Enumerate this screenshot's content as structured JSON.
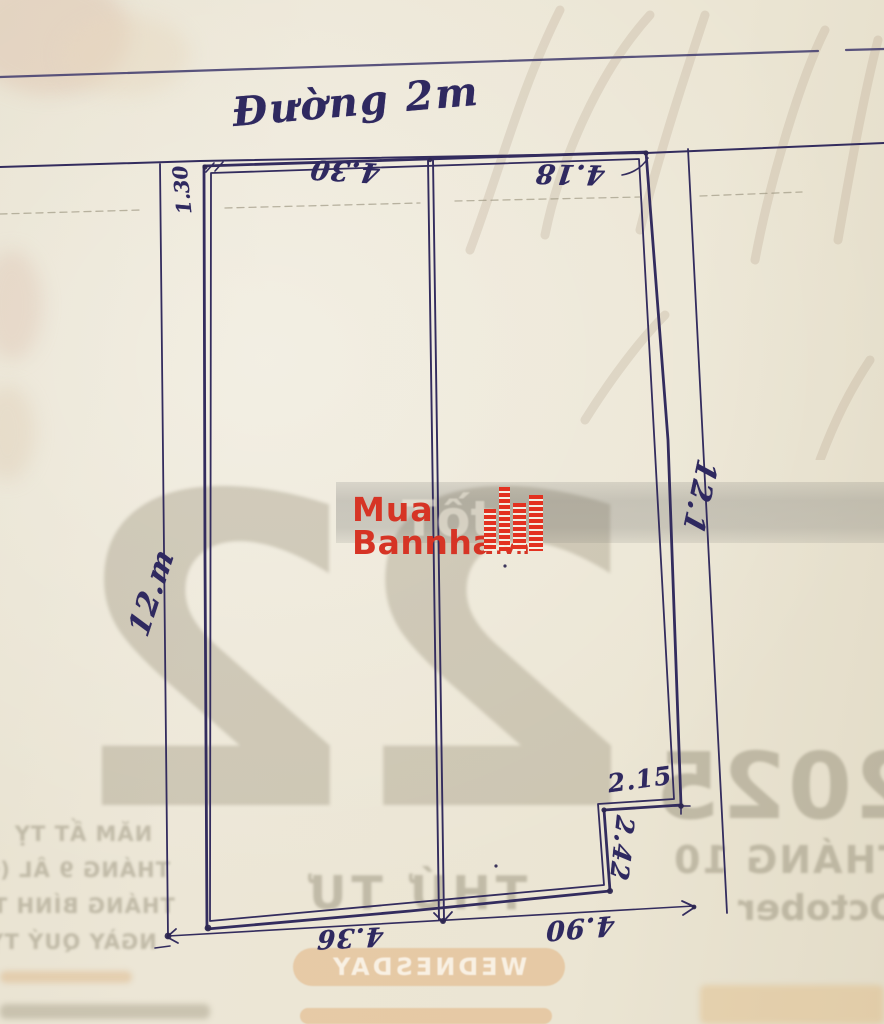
{
  "road_label": "Đường 2m",
  "dimensions": {
    "top_left": "4.30",
    "top_right": "4.18",
    "setback": "1.30",
    "left_side": "12.m",
    "right_side": "12.1",
    "notch_width": "2.15",
    "notch_height": "2.42",
    "bottom_left": "4.36",
    "bottom_right": "4.90"
  },
  "watermark": {
    "line1": "Mua",
    "line2": "Bannha",
    "suffix": ".vn",
    "faint_text": "Tốt",
    "color": "#d63425"
  },
  "calendar": {
    "day_number": "22",
    "year": "2025",
    "month_vi": "THÁNG 10",
    "month_en": "October",
    "weekday_vi": "THỨ TƯ",
    "weekday_en": "WEDNESDAY",
    "left_lines": [
      "NĂM ẤT TỴ",
      "THÁNG 9 ÂL (Đ)",
      "THÁNG BÍNH TUẤT",
      "NGÀY QUÝ TỴ"
    ]
  },
  "colors": {
    "ink": "#332c5e",
    "paper": "#ebe5d4",
    "logo_red": "#d63425",
    "showthrough_gray": "#8e8770",
    "band_orange": "#de9954"
  }
}
